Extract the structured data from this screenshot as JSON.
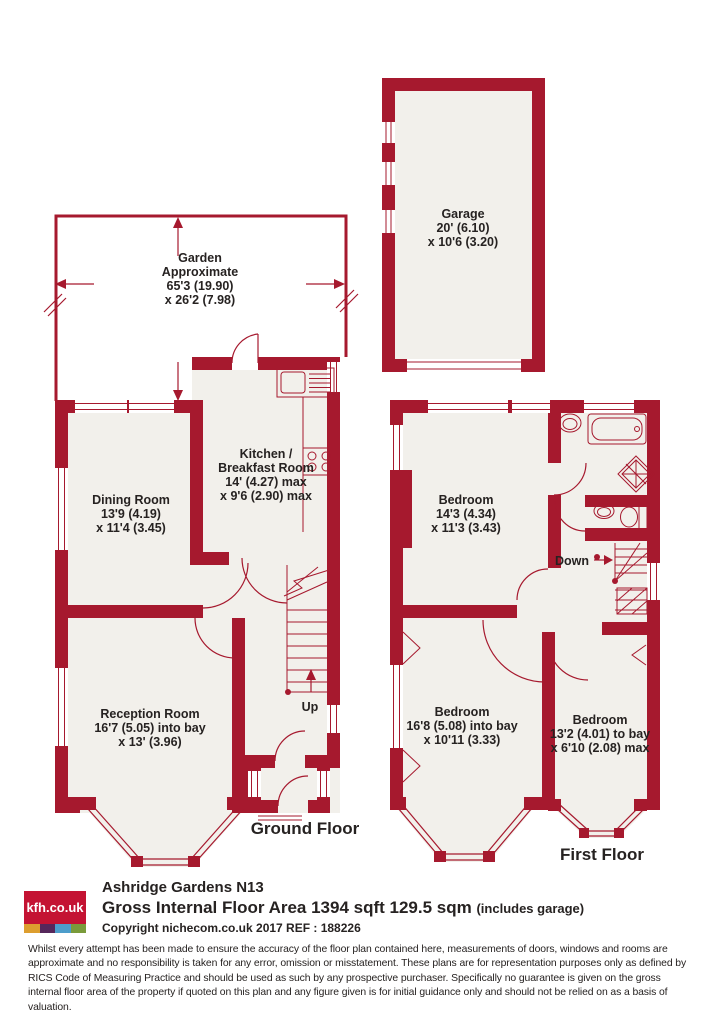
{
  "colors": {
    "wall": "#A6192E",
    "room": "#F2F0EB",
    "ink": "#262221",
    "logo_red": "#C41333",
    "logo_orange": "#DD9E2F",
    "logo_purple": "#56275B",
    "logo_blue": "#4D9DCB",
    "logo_green": "#7A9B3B"
  },
  "garden": {
    "lines": [
      "Garden",
      "Approximate",
      "65'3 (19.90)",
      "x 26'2 (7.98)"
    ]
  },
  "garage": {
    "lines": [
      "Garage",
      "20' (6.10)",
      "x 10'6 (3.20)"
    ]
  },
  "ground_floor": {
    "label": "Ground Floor",
    "stairs_label": "Up",
    "rooms": {
      "dining": {
        "lines": [
          "Dining Room",
          "13'9 (4.19)",
          "x 11'4 (3.45)"
        ]
      },
      "kitchen": {
        "lines": [
          "Kitchen /",
          "Breakfast Room",
          "14' (4.27) max",
          "x 9'6 (2.90) max"
        ]
      },
      "reception": {
        "lines": [
          "Reception Room",
          "16'7 (5.05) into bay",
          "x 13' (3.96)"
        ]
      }
    }
  },
  "first_floor": {
    "label": "First Floor",
    "stairs_label": "Down",
    "rooms": {
      "bedroom1": {
        "lines": [
          "Bedroom",
          "14'3 (4.34)",
          "x 11'3 (3.43)"
        ]
      },
      "bedroom2": {
        "lines": [
          "Bedroom",
          "16'8 (5.08) into bay",
          "x 10'11 (3.33)"
        ]
      },
      "bedroom3": {
        "lines": [
          "Bedroom",
          "13'2 (4.01) to bay",
          "x 6'10 (2.08) max"
        ]
      }
    }
  },
  "footer": {
    "logo_text": "kfh.co.uk",
    "address": "Ashridge Gardens  N13",
    "area_main": "Gross Internal Floor Area 1394 sqft 129.5 sqm",
    "area_note": "(includes garage)",
    "copyright": "Copyright nichecom.co.uk 2017 REF : 188226",
    "disclaimer": "Whilst every attempt has been made to ensure the accuracy of the floor plan contained here, measurements of doors, windows and rooms are approximate and no responsibility is taken for any error, omission or misstatement.  These plans are for representation purposes only as defined by RICS Code of Measuring Practice and should be used as such by any prospective purchaser.  Specifically no guarantee is given on the gross internal floor area of the property if quoted on this plan and any figure given is for initial guidance only and should not be relied on as a basis of valuation."
  }
}
